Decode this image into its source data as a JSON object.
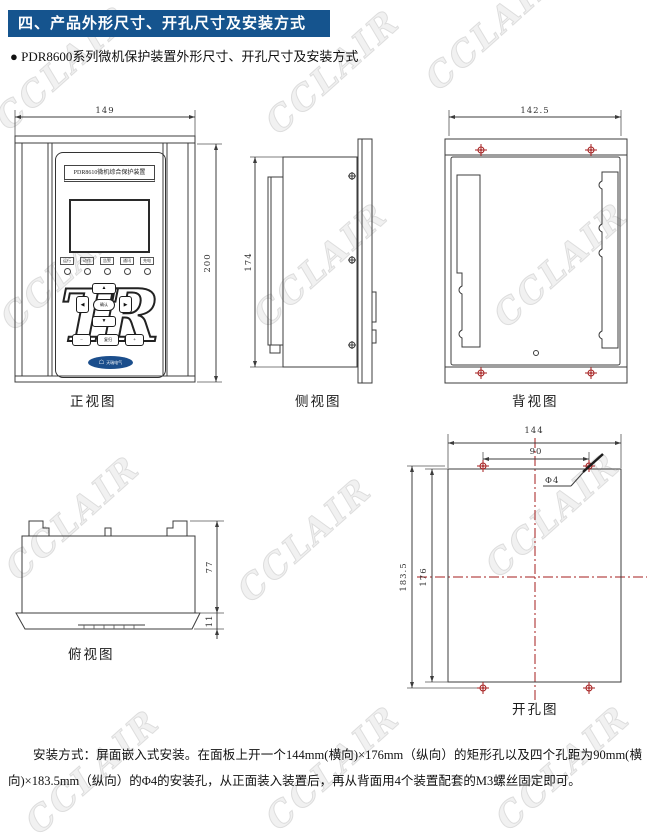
{
  "header": {
    "title": "四、产品外形尺寸、开孔尺寸及安装方式"
  },
  "intro": {
    "bullet": "● PDR8600系列微机保护装置外形尺寸、开孔尺寸及安装方式"
  },
  "watermark": {
    "text": "CCLAIR"
  },
  "views": {
    "front": {
      "label": "正视图",
      "dims": {
        "width": "149",
        "height": "200"
      },
      "device": {
        "title": "PDR8610微机综合保护装置",
        "indicators": [
          "运行",
          "动作",
          "告警",
          "通讯",
          "充电"
        ],
        "logo": "TR",
        "keys": {
          "up": "▲",
          "down": "▼",
          "left": "◀",
          "right": "▶",
          "center": "确认",
          "minus": "−",
          "reset": "复归",
          "plus": "+"
        },
        "brand": "天瑞电气"
      }
    },
    "side": {
      "label": "侧视图",
      "dims": {
        "height": "174"
      }
    },
    "back": {
      "label": "背视图",
      "dims": {
        "width": "142.5"
      }
    },
    "top": {
      "label": "俯视图",
      "dims": {
        "depth": "77",
        "panel": "11"
      }
    },
    "hole": {
      "label": "开孔图",
      "dims": {
        "width": "144",
        "hole_spacing_w": "90",
        "height_outer": "183.5",
        "height_inner": "176",
        "hole_diameter": "Φ4"
      }
    }
  },
  "footer": {
    "paragraph": "安装方式：屏面嵌入式安装。在面板上开一个144mm(横向)×176mm（纵向）的矩形孔以及四个孔距为90mm(横向)×183.5mm（纵向）的Φ4的安装孔，从正面装入装置后，再从背面用4个装置配套的M3螺丝固定即可。"
  }
}
